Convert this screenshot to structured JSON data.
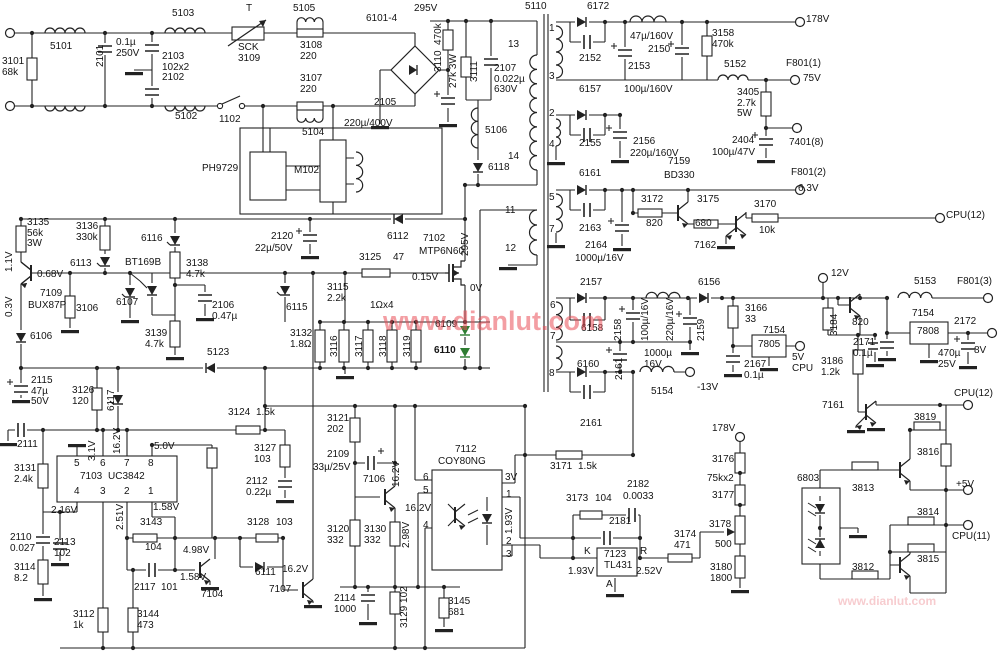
{
  "title": "TV switching power supply schematic",
  "colors": {
    "wire": "#222222",
    "label": "#141414",
    "green_diode": "#2e7d32",
    "watermark": "rgba(233,78,88,0.55)"
  },
  "watermarks": [
    {
      "t": "www.dianlut.com",
      "x": 383,
      "y": 306,
      "fs": 27,
      "c": "rgba(233,78,88,0.55)"
    },
    {
      "t": "www.dianlut.com",
      "x": 838,
      "y": 594,
      "fs": 12,
      "c": "rgba(233,120,130,0.38)"
    }
  ],
  "labels": [
    {
      "t": "3101\n68k",
      "x": 2,
      "y": 57
    },
    {
      "t": "5101",
      "x": 50,
      "y": 42
    },
    {
      "t": "2101",
      "x": 96,
      "y": 67,
      "v": 1
    },
    {
      "t": "0.1µ\n250V",
      "x": 116,
      "y": 38
    },
    {
      "t": "2103\n102x2\n2102",
      "x": 162,
      "y": 52
    },
    {
      "t": "5103",
      "x": 172,
      "y": 9
    },
    {
      "t": "T",
      "x": 246,
      "y": 4
    },
    {
      "t": "SCK\n3109",
      "x": 238,
      "y": 43
    },
    {
      "t": "5102",
      "x": 175,
      "y": 112
    },
    {
      "t": "1102",
      "x": 219,
      "y": 115
    },
    {
      "t": "5105",
      "x": 293,
      "y": 4
    },
    {
      "t": "3108\n220",
      "x": 300,
      "y": 41
    },
    {
      "t": "3107\n220",
      "x": 300,
      "y": 74
    },
    {
      "t": "5104",
      "x": 302,
      "y": 128
    },
    {
      "t": "6101-4",
      "x": 366,
      "y": 14
    },
    {
      "t": "2105",
      "x": 374,
      "y": 98
    },
    {
      "t": "220µ/400V",
      "x": 344,
      "y": 119
    },
    {
      "t": "295V",
      "x": 414,
      "y": 4
    },
    {
      "t": "3110  470k",
      "x": 434,
      "y": 72,
      "v": 1
    },
    {
      "t": "27k 3W",
      "x": 449,
      "y": 88,
      "v": 1
    },
    {
      "t": "3111",
      "x": 470,
      "y": 82,
      "v": 1
    },
    {
      "t": "2107\n0.022µ\n630V",
      "x": 494,
      "y": 64
    },
    {
      "t": "5106",
      "x": 485,
      "y": 126
    },
    {
      "t": "6118",
      "x": 488,
      "y": 163
    },
    {
      "t": "5110",
      "x": 525,
      "y": 2
    },
    {
      "t": "13",
      "x": 508,
      "y": 40
    },
    {
      "t": "14",
      "x": 508,
      "y": 152
    },
    {
      "t": "11",
      "x": 505,
      "y": 206
    },
    {
      "t": "12",
      "x": 505,
      "y": 244
    },
    {
      "t": "PH9729",
      "x": 202,
      "y": 164
    },
    {
      "t": "M102",
      "x": 294,
      "y": 166
    },
    {
      "t": "6172",
      "x": 587,
      "y": 2
    },
    {
      "t": "1",
      "x": 549,
      "y": 24
    },
    {
      "t": "3",
      "x": 549,
      "y": 72
    },
    {
      "t": "2152",
      "x": 579,
      "y": 54
    },
    {
      "t": "47µ/160V",
      "x": 630,
      "y": 32
    },
    {
      "t": "2150",
      "x": 648,
      "y": 45
    },
    {
      "t": "2153",
      "x": 628,
      "y": 62
    },
    {
      "t": "100µ/160V",
      "x": 624,
      "y": 85
    },
    {
      "t": "3158\n470k",
      "x": 712,
      "y": 29
    },
    {
      "t": "5152",
      "x": 724,
      "y": 60
    },
    {
      "t": "F801(1)",
      "x": 786,
      "y": 59
    },
    {
      "t": "75V",
      "x": 803,
      "y": 74
    },
    {
      "t": "178V",
      "x": 806,
      "y": 15
    },
    {
      "t": "6157",
      "x": 579,
      "y": 85
    },
    {
      "t": "2",
      "x": 549,
      "y": 109
    },
    {
      "t": "4",
      "x": 549,
      "y": 140
    },
    {
      "t": "2155",
      "x": 579,
      "y": 139
    },
    {
      "t": "2156",
      "x": 633,
      "y": 137
    },
    {
      "t": "220µ/160V",
      "x": 630,
      "y": 149
    },
    {
      "t": "3405\n2.7k\n5W",
      "x": 737,
      "y": 88
    },
    {
      "t": "2404",
      "x": 732,
      "y": 136
    },
    {
      "t": "100µ/47V",
      "x": 712,
      "y": 148
    },
    {
      "t": "7401(8)",
      "x": 789,
      "y": 138
    },
    {
      "t": "F801(2)",
      "x": 791,
      "y": 168
    },
    {
      "t": "6.3V",
      "x": 798,
      "y": 184
    },
    {
      "t": "7159",
      "x": 668,
      "y": 157
    },
    {
      "t": "BD330",
      "x": 664,
      "y": 171
    },
    {
      "t": "6161",
      "x": 579,
      "y": 169
    },
    {
      "t": "5",
      "x": 549,
      "y": 193
    },
    {
      "t": "7",
      "x": 549,
      "y": 225
    },
    {
      "t": "2163",
      "x": 579,
      "y": 224
    },
    {
      "t": "2164",
      "x": 585,
      "y": 241
    },
    {
      "t": "1000µ/16V",
      "x": 575,
      "y": 254
    },
    {
      "t": "3172",
      "x": 641,
      "y": 195
    },
    {
      "t": "820",
      "x": 646,
      "y": 219
    },
    {
      "t": "3175",
      "x": 697,
      "y": 195
    },
    {
      "t": "680",
      "x": 695,
      "y": 219
    },
    {
      "t": "7162",
      "x": 694,
      "y": 241
    },
    {
      "t": "3170",
      "x": 754,
      "y": 200
    },
    {
      "t": "10k",
      "x": 759,
      "y": 226
    },
    {
      "t": "CPU(12)",
      "x": 946,
      "y": 211
    },
    {
      "t": "2157",
      "x": 580,
      "y": 278
    },
    {
      "t": "6",
      "x": 550,
      "y": 301
    },
    {
      "t": "6158",
      "x": 581,
      "y": 324
    },
    {
      "t": "2158",
      "x": 614,
      "y": 341,
      "v": 1
    },
    {
      "t": "7",
      "x": 550,
      "y": 332
    },
    {
      "t": "100µ/16V",
      "x": 641,
      "y": 341,
      "v": 1
    },
    {
      "t": "220µ/16V",
      "x": 666,
      "y": 341,
      "v": 1
    },
    {
      "t": "2159",
      "x": 697,
      "y": 341,
      "v": 1
    },
    {
      "t": "6156",
      "x": 698,
      "y": 278
    },
    {
      "t": "3166\n33",
      "x": 745,
      "y": 304
    },
    {
      "t": "7154",
      "x": 763,
      "y": 326
    },
    {
      "t": "7805",
      "x": 758,
      "y": 340
    },
    {
      "t": "5V\nCPU",
      "x": 792,
      "y": 353
    },
    {
      "t": "2167\n0.1µ",
      "x": 744,
      "y": 360
    },
    {
      "t": "8",
      "x": 549,
      "y": 369
    },
    {
      "t": "6160",
      "x": 577,
      "y": 360
    },
    {
      "t": "2161",
      "x": 615,
      "y": 380,
      "v": 1
    },
    {
      "t": "1000µ\n16V",
      "x": 644,
      "y": 349
    },
    {
      "t": "5154",
      "x": 651,
      "y": 387
    },
    {
      "t": "-13V",
      "x": 697,
      "y": 383
    },
    {
      "t": "2161",
      "x": 580,
      "y": 419
    },
    {
      "t": "3171",
      "x": 550,
      "y": 462
    },
    {
      "t": "1.5k",
      "x": 578,
      "y": 462
    },
    {
      "t": "12V",
      "x": 831,
      "y": 269
    },
    {
      "t": "5153",
      "x": 914,
      "y": 277
    },
    {
      "t": "F801(3)",
      "x": 957,
      "y": 277
    },
    {
      "t": "3184",
      "x": 830,
      "y": 336,
      "v": 1
    },
    {
      "t": "820",
      "x": 852,
      "y": 318
    },
    {
      "t": "7154",
      "x": 912,
      "y": 309
    },
    {
      "t": "7808",
      "x": 917,
      "y": 327
    },
    {
      "t": "2172",
      "x": 954,
      "y": 317
    },
    {
      "t": "2171\n0.1µ",
      "x": 853,
      "y": 338
    },
    {
      "t": "470µ\n25V",
      "x": 938,
      "y": 349
    },
    {
      "t": "8V",
      "x": 974,
      "y": 346
    },
    {
      "t": "3186\n1.2k",
      "x": 821,
      "y": 357
    },
    {
      "t": "7161",
      "x": 822,
      "y": 401
    },
    {
      "t": "CPU(12)",
      "x": 954,
      "y": 389
    },
    {
      "t": "3819",
      "x": 914,
      "y": 413
    },
    {
      "t": "3816",
      "x": 917,
      "y": 448
    },
    {
      "t": "3813",
      "x": 852,
      "y": 484
    },
    {
      "t": "+5V",
      "x": 956,
      "y": 480
    },
    {
      "t": "3814",
      "x": 917,
      "y": 508
    },
    {
      "t": "CPU(11)",
      "x": 952,
      "y": 532
    },
    {
      "t": "3815",
      "x": 917,
      "y": 555
    },
    {
      "t": "3812",
      "x": 852,
      "y": 563
    },
    {
      "t": "6803",
      "x": 797,
      "y": 474
    },
    {
      "t": "178V",
      "x": 712,
      "y": 424
    },
    {
      "t": "3176",
      "x": 712,
      "y": 455
    },
    {
      "t": "75kx2",
      "x": 707,
      "y": 474
    },
    {
      "t": "3177",
      "x": 712,
      "y": 491
    },
    {
      "t": "3178",
      "x": 709,
      "y": 520
    },
    {
      "t": "500",
      "x": 715,
      "y": 540
    },
    {
      "t": "3180\n1800",
      "x": 710,
      "y": 563
    },
    {
      "t": "3173",
      "x": 566,
      "y": 494
    },
    {
      "t": "104",
      "x": 595,
      "y": 494
    },
    {
      "t": "2182",
      "x": 627,
      "y": 480
    },
    {
      "t": "0.0033",
      "x": 623,
      "y": 492
    },
    {
      "t": "2181",
      "x": 609,
      "y": 517
    },
    {
      "t": "K",
      "x": 584,
      "y": 547
    },
    {
      "t": "R",
      "x": 640,
      "y": 547
    },
    {
      "t": "7123\nTL431",
      "x": 604,
      "y": 550
    },
    {
      "t": "1.93V",
      "x": 568,
      "y": 567
    },
    {
      "t": "2.52V",
      "x": 636,
      "y": 567
    },
    {
      "t": "A",
      "x": 606,
      "y": 580
    },
    {
      "t": "3174\n471",
      "x": 674,
      "y": 530
    },
    {
      "t": "7112",
      "x": 455,
      "y": 445
    },
    {
      "t": "COY80NG",
      "x": 438,
      "y": 457
    },
    {
      "t": "6",
      "x": 423,
      "y": 473
    },
    {
      "t": "5",
      "x": 423,
      "y": 486
    },
    {
      "t": "4",
      "x": 423,
      "y": 521
    },
    {
      "t": "16.2V",
      "x": 405,
      "y": 504
    },
    {
      "t": "3V",
      "x": 505,
      "y": 473
    },
    {
      "t": "1",
      "x": 506,
      "y": 490
    },
    {
      "t": "1.93V",
      "x": 505,
      "y": 534,
      "v": 1
    },
    {
      "t": "2",
      "x": 506,
      "y": 537
    },
    {
      "t": "3",
      "x": 506,
      "y": 550
    },
    {
      "t": "3135\n56k\n3W",
      "x": 27,
      "y": 218
    },
    {
      "t": "1.1V",
      "x": 5,
      "y": 272,
      "v": 1
    },
    {
      "t": "0.68V",
      "x": 37,
      "y": 270
    },
    {
      "t": "0.3V",
      "x": 5,
      "y": 317,
      "v": 1
    },
    {
      "t": "7109",
      "x": 40,
      "y": 289
    },
    {
      "t": "BUX87P",
      "x": 28,
      "y": 301
    },
    {
      "t": "3136\n330k",
      "x": 76,
      "y": 222
    },
    {
      "t": "6113",
      "x": 70,
      "y": 259
    },
    {
      "t": "3106",
      "x": 76,
      "y": 304
    },
    {
      "t": "6107",
      "x": 116,
      "y": 298
    },
    {
      "t": "BT169B",
      "x": 125,
      "y": 258
    },
    {
      "t": "6116",
      "x": 141,
      "y": 234
    },
    {
      "t": "3138\n4.7k",
      "x": 186,
      "y": 259
    },
    {
      "t": "2106\n0.47µ",
      "x": 212,
      "y": 301
    },
    {
      "t": "3139\n4.7k",
      "x": 145,
      "y": 329
    },
    {
      "t": "6106",
      "x": 30,
      "y": 332
    },
    {
      "t": "5123",
      "x": 207,
      "y": 348
    },
    {
      "t": "2115\n47µ\n50V",
      "x": 31,
      "y": 376
    },
    {
      "t": "3126\n120",
      "x": 72,
      "y": 386
    },
    {
      "t": "6117",
      "x": 107,
      "y": 411,
      "v": 1
    },
    {
      "t": "2120",
      "x": 271,
      "y": 232
    },
    {
      "t": "22µ/50V",
      "x": 255,
      "y": 244
    },
    {
      "t": "6112",
      "x": 387,
      "y": 232
    },
    {
      "t": "7102",
      "x": 423,
      "y": 234
    },
    {
      "t": "MTP6N60",
      "x": 419,
      "y": 247
    },
    {
      "t": "3125",
      "x": 359,
      "y": 253
    },
    {
      "t": "47",
      "x": 393,
      "y": 253
    },
    {
      "t": "0.15V",
      "x": 412,
      "y": 273
    },
    {
      "t": "295V",
      "x": 461,
      "y": 256,
      "v": 1
    },
    {
      "t": "0V",
      "x": 470,
      "y": 284
    },
    {
      "t": "6115",
      "x": 286,
      "y": 303
    },
    {
      "t": "3115\n2.2k",
      "x": 327,
      "y": 283
    },
    {
      "t": "1Ωx4",
      "x": 370,
      "y": 301
    },
    {
      "t": "3132\n1.8Ω",
      "x": 290,
      "y": 329
    },
    {
      "t": "3116",
      "x": 330,
      "y": 357,
      "v": 1
    },
    {
      "t": "3117",
      "x": 355,
      "y": 357,
      "v": 1
    },
    {
      "t": "3118",
      "x": 379,
      "y": 357,
      "v": 1
    },
    {
      "t": "3119",
      "x": 403,
      "y": 357,
      "v": 1
    },
    {
      "t": "6109",
      "x": 435,
      "y": 320
    },
    {
      "t": "6110",
      "x": 434,
      "y": 346,
      "b": 1
    },
    {
      "t": "2111",
      "x": 17,
      "y": 440
    },
    {
      "t": "3131\n2.4k",
      "x": 14,
      "y": 464
    },
    {
      "t": "3.1V",
      "x": 88,
      "y": 461,
      "v": 1
    },
    {
      "t": "16.2V",
      "x": 113,
      "y": 454,
      "v": 1
    },
    {
      "t": "5.0V",
      "x": 154,
      "y": 442
    },
    {
      "t": "5",
      "x": 74,
      "y": 459
    },
    {
      "t": "6",
      "x": 100,
      "y": 459
    },
    {
      "t": "7",
      "x": 124,
      "y": 459
    },
    {
      "t": "8",
      "x": 148,
      "y": 459
    },
    {
      "t": "7103",
      "x": 80,
      "y": 472
    },
    {
      "t": "UC3842",
      "x": 108,
      "y": 472
    },
    {
      "t": "4",
      "x": 74,
      "y": 487
    },
    {
      "t": "3",
      "x": 100,
      "y": 487
    },
    {
      "t": "2",
      "x": 124,
      "y": 487
    },
    {
      "t": "1",
      "x": 148,
      "y": 487
    },
    {
      "t": "2.16V",
      "x": 51,
      "y": 506
    },
    {
      "t": "2.51V",
      "x": 116,
      "y": 530,
      "v": 1
    },
    {
      "t": "1.58V",
      "x": 153,
      "y": 503
    },
    {
      "t": "2110\n0.027",
      "x": 10,
      "y": 533
    },
    {
      "t": "2113\n102",
      "x": 54,
      "y": 538
    },
    {
      "t": "3114\n8.2",
      "x": 14,
      "y": 563
    },
    {
      "t": "3143",
      "x": 140,
      "y": 518
    },
    {
      "t": "104",
      "x": 145,
      "y": 543
    },
    {
      "t": "4.98V",
      "x": 183,
      "y": 546
    },
    {
      "t": "2117",
      "x": 134,
      "y": 583
    },
    {
      "t": "101",
      "x": 161,
      "y": 583
    },
    {
      "t": "1.58V",
      "x": 180,
      "y": 573
    },
    {
      "t": "7104",
      "x": 201,
      "y": 590
    },
    {
      "t": "3112\n1k",
      "x": 73,
      "y": 610
    },
    {
      "t": "3144\n473",
      "x": 137,
      "y": 610
    },
    {
      "t": "3124",
      "x": 228,
      "y": 408
    },
    {
      "t": "1.5k",
      "x": 256,
      "y": 408
    },
    {
      "t": "3127\n103",
      "x": 254,
      "y": 444
    },
    {
      "t": "2112\n0.22µ",
      "x": 246,
      "y": 477
    },
    {
      "t": "3128",
      "x": 247,
      "y": 518
    },
    {
      "t": "103",
      "x": 276,
      "y": 518
    },
    {
      "t": "6111",
      "x": 255,
      "y": 568
    },
    {
      "t": "16.2V",
      "x": 282,
      "y": 565
    },
    {
      "t": "7107",
      "x": 269,
      "y": 585
    },
    {
      "t": "3121\n202",
      "x": 327,
      "y": 414
    },
    {
      "t": "2109",
      "x": 327,
      "y": 450
    },
    {
      "t": "33µ/25V",
      "x": 313,
      "y": 463
    },
    {
      "t": "7106",
      "x": 363,
      "y": 475
    },
    {
      "t": "16.2V",
      "x": 392,
      "y": 487,
      "v": 1
    },
    {
      "t": "3120\n332",
      "x": 327,
      "y": 525
    },
    {
      "t": "3130\n332",
      "x": 364,
      "y": 525
    },
    {
      "t": "2.98V",
      "x": 402,
      "y": 548,
      "v": 1
    },
    {
      "t": "2114\n1000",
      "x": 334,
      "y": 594
    },
    {
      "t": "3129 102",
      "x": 400,
      "y": 628,
      "v": 1
    },
    {
      "t": "3145\n681",
      "x": 448,
      "y": 597
    }
  ]
}
